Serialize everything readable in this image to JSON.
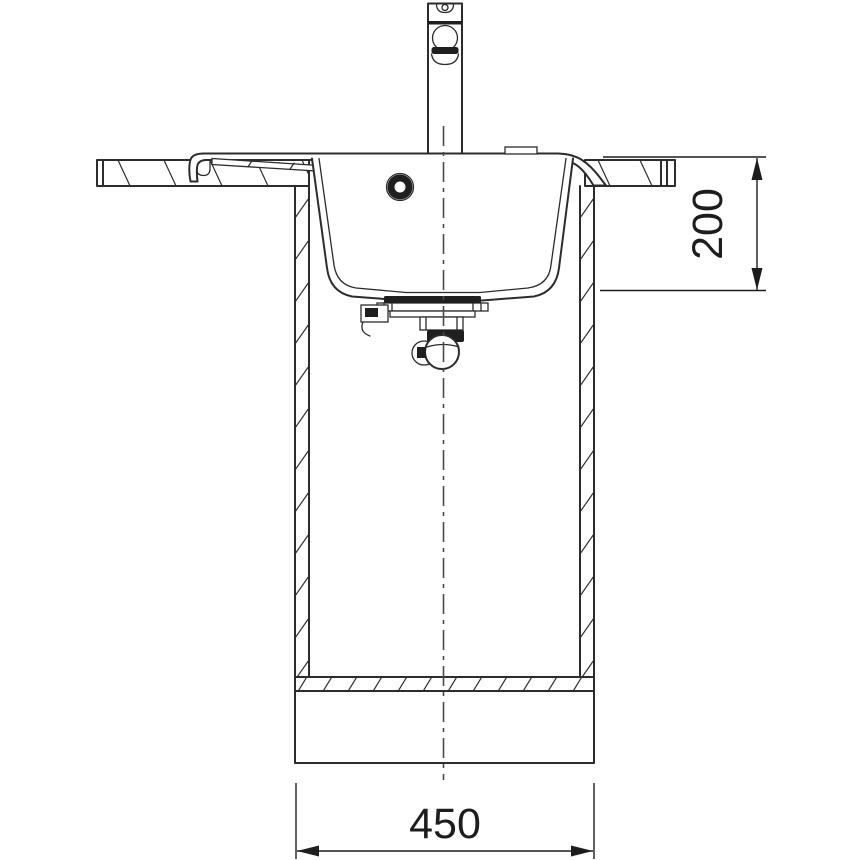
{
  "drawing": {
    "title": "Sink front-section installation drawing",
    "colors": {
      "background": "#ffffff",
      "line": "#2c2c2c",
      "dark_fill": "#1f1f1f",
      "centerline": "#4a4a4a",
      "dimension": "#1d1d1d"
    },
    "dimensions": {
      "depth": {
        "label": "200",
        "orientation": "vertical"
      },
      "width": {
        "label": "450",
        "orientation": "horizontal"
      }
    },
    "components": {
      "faucet": "mixer-tap",
      "tap_hole_cover": "tap-hole-cover",
      "countertop_left": "worktop-left-section",
      "countertop_right": "worktop-right-section",
      "sink_rim": "sink-rim-ledge",
      "drainer_ledge": "drainer-ledge-grooves",
      "basin": "sink-bowl",
      "overflow": "overflow-opening",
      "drain_flange": "strainer-waste-flange",
      "trap": "siphon-trap",
      "cabinet": "base-cabinet",
      "bottom_panel": "cabinet-bottom-panel",
      "plinth": "plinth",
      "centerline": "center-line"
    }
  }
}
